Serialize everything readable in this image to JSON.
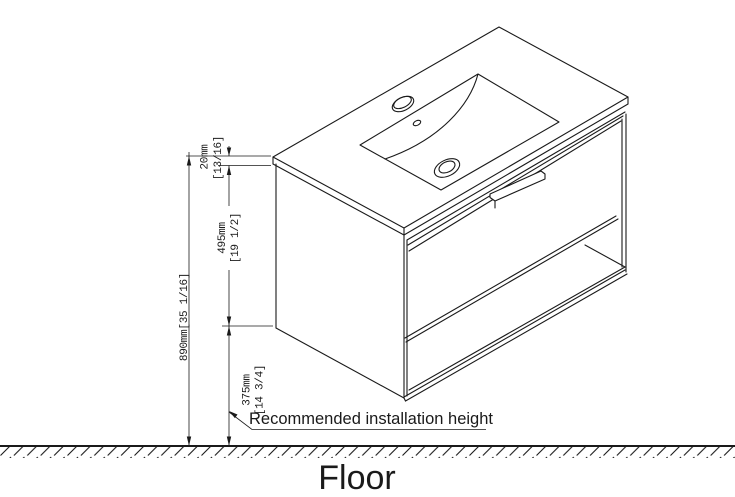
{
  "drawing": {
    "subject": "wall-hung-vanity-installation-diagram",
    "background_color": "#ffffff",
    "line_color": "#1a1a1a"
  },
  "dimensions": {
    "counter_thickness": {
      "metric": "20mm",
      "imperial": "[13/16]"
    },
    "cabinet_height": {
      "metric": "495mm",
      "imperial": "[19 1/2]"
    },
    "overall_height": {
      "combined": "890mm[35 1/16]"
    },
    "floor_clearance": {
      "metric": "375mm",
      "imperial": "[14 3/4]"
    }
  },
  "annotations": {
    "installation_note": "Recommended installation height",
    "floor_label": "Floor"
  }
}
